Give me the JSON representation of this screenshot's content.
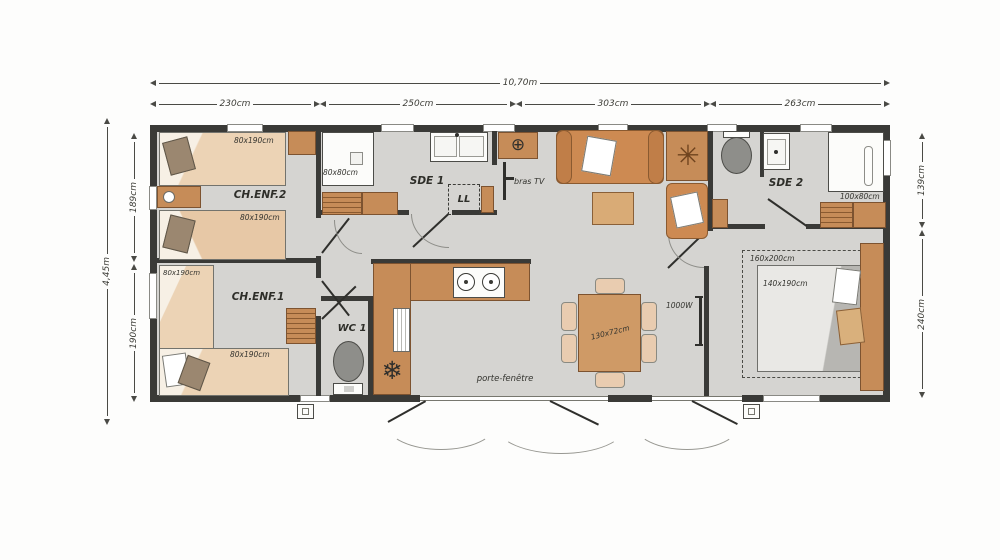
{
  "dimensions": {
    "overall_width": "10,70m",
    "overall_height": "4,45m",
    "top": [
      "230cm",
      "250cm",
      "303cm",
      "263cm"
    ],
    "left": [
      "189cm",
      "190cm"
    ],
    "right": [
      "139cm",
      "240cm"
    ]
  },
  "rooms": {
    "ch_enf_2": {
      "label": "CH.ENF.2",
      "bed_top": "80x190cm",
      "bed_bottom": "80x190cm"
    },
    "ch_enf_1": {
      "label": "CH.ENF.1",
      "bed_left": "80x190cm",
      "bed_bottom": "80x190cm"
    },
    "sde_1": {
      "label": "SDE 1",
      "shower": "80x80cm",
      "washing_machine": "LL"
    },
    "wc_1": {
      "label": "WC 1"
    },
    "living": {
      "tv_mount": "bras TV",
      "radiator_power": "1000W"
    },
    "dining": {
      "table": "130x72cm"
    },
    "sde_2": {
      "label": "SDE 2",
      "shower": "100x80cm"
    },
    "master_bedroom": {
      "bed_zone": "160x200cm",
      "bed": "140x190cm"
    }
  },
  "exterior": {
    "patio_door": "porte-fenêtre"
  },
  "icons": {
    "fridge": "❄",
    "rosette": "✳",
    "ceiling_light": "⊕"
  },
  "colors": {
    "wall": "#3a3a37",
    "floor": "#d5d4d1",
    "wood": "#c68c58",
    "sofa": "#cd8a52"
  }
}
